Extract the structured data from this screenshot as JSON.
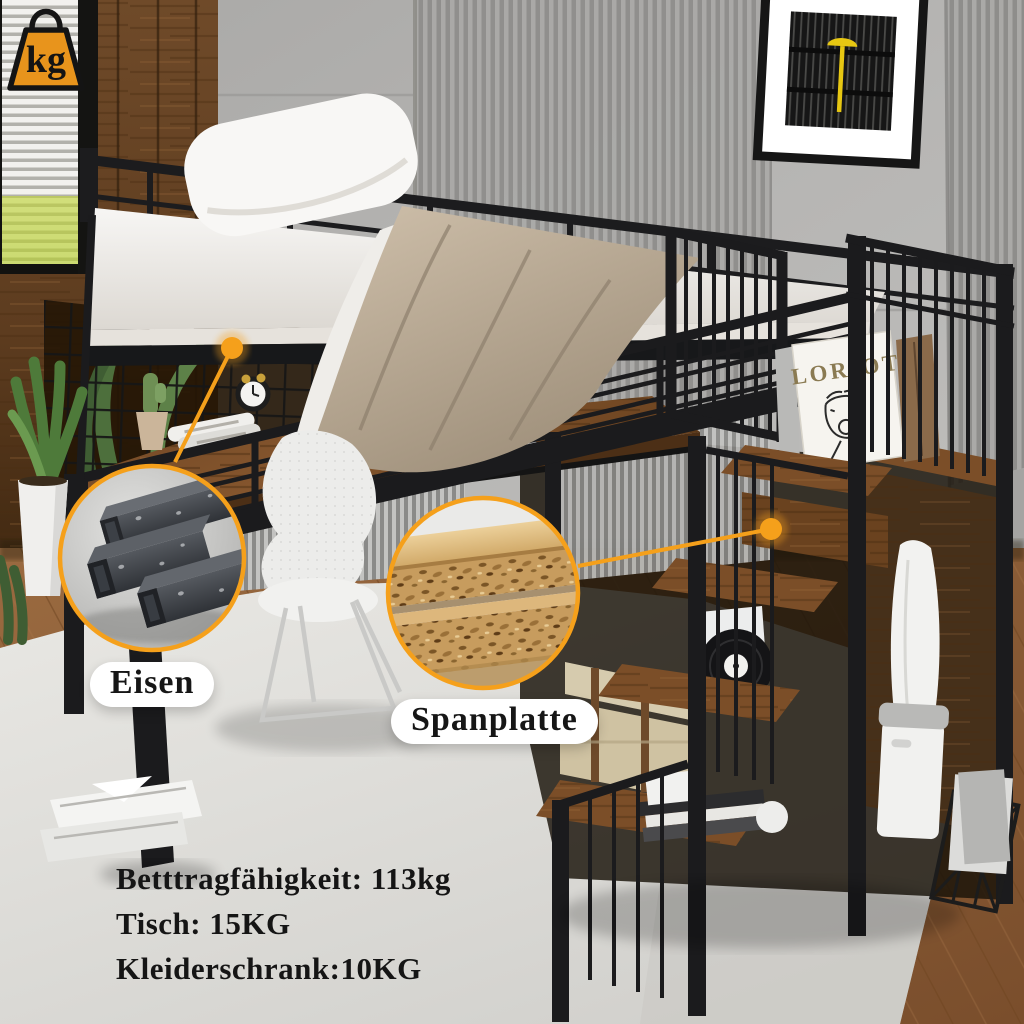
{
  "labels": {
    "material_callouts": [
      {
        "id": "eisen",
        "label": "Eisen"
      },
      {
        "id": "spanplatte",
        "label": "Spanplatte"
      }
    ]
  },
  "specs": {
    "badge": "kg",
    "lines": [
      "Betttragfähigkeit: 113kg",
      "Tisch: 15KG",
      "Kleiderschrank:10KG"
    ]
  },
  "scene": {
    "book_title": "LORIOT"
  },
  "colors": {
    "accent_orange": "#F5A01B",
    "badge_orange": "#E8941C",
    "metal_black": "#1b1b1d",
    "wood_rustic": "#7b4e28",
    "chipboard_tan": "#c79c5e",
    "wall_concrete": "#b3b2b0",
    "rug": "#e3e2de"
  }
}
